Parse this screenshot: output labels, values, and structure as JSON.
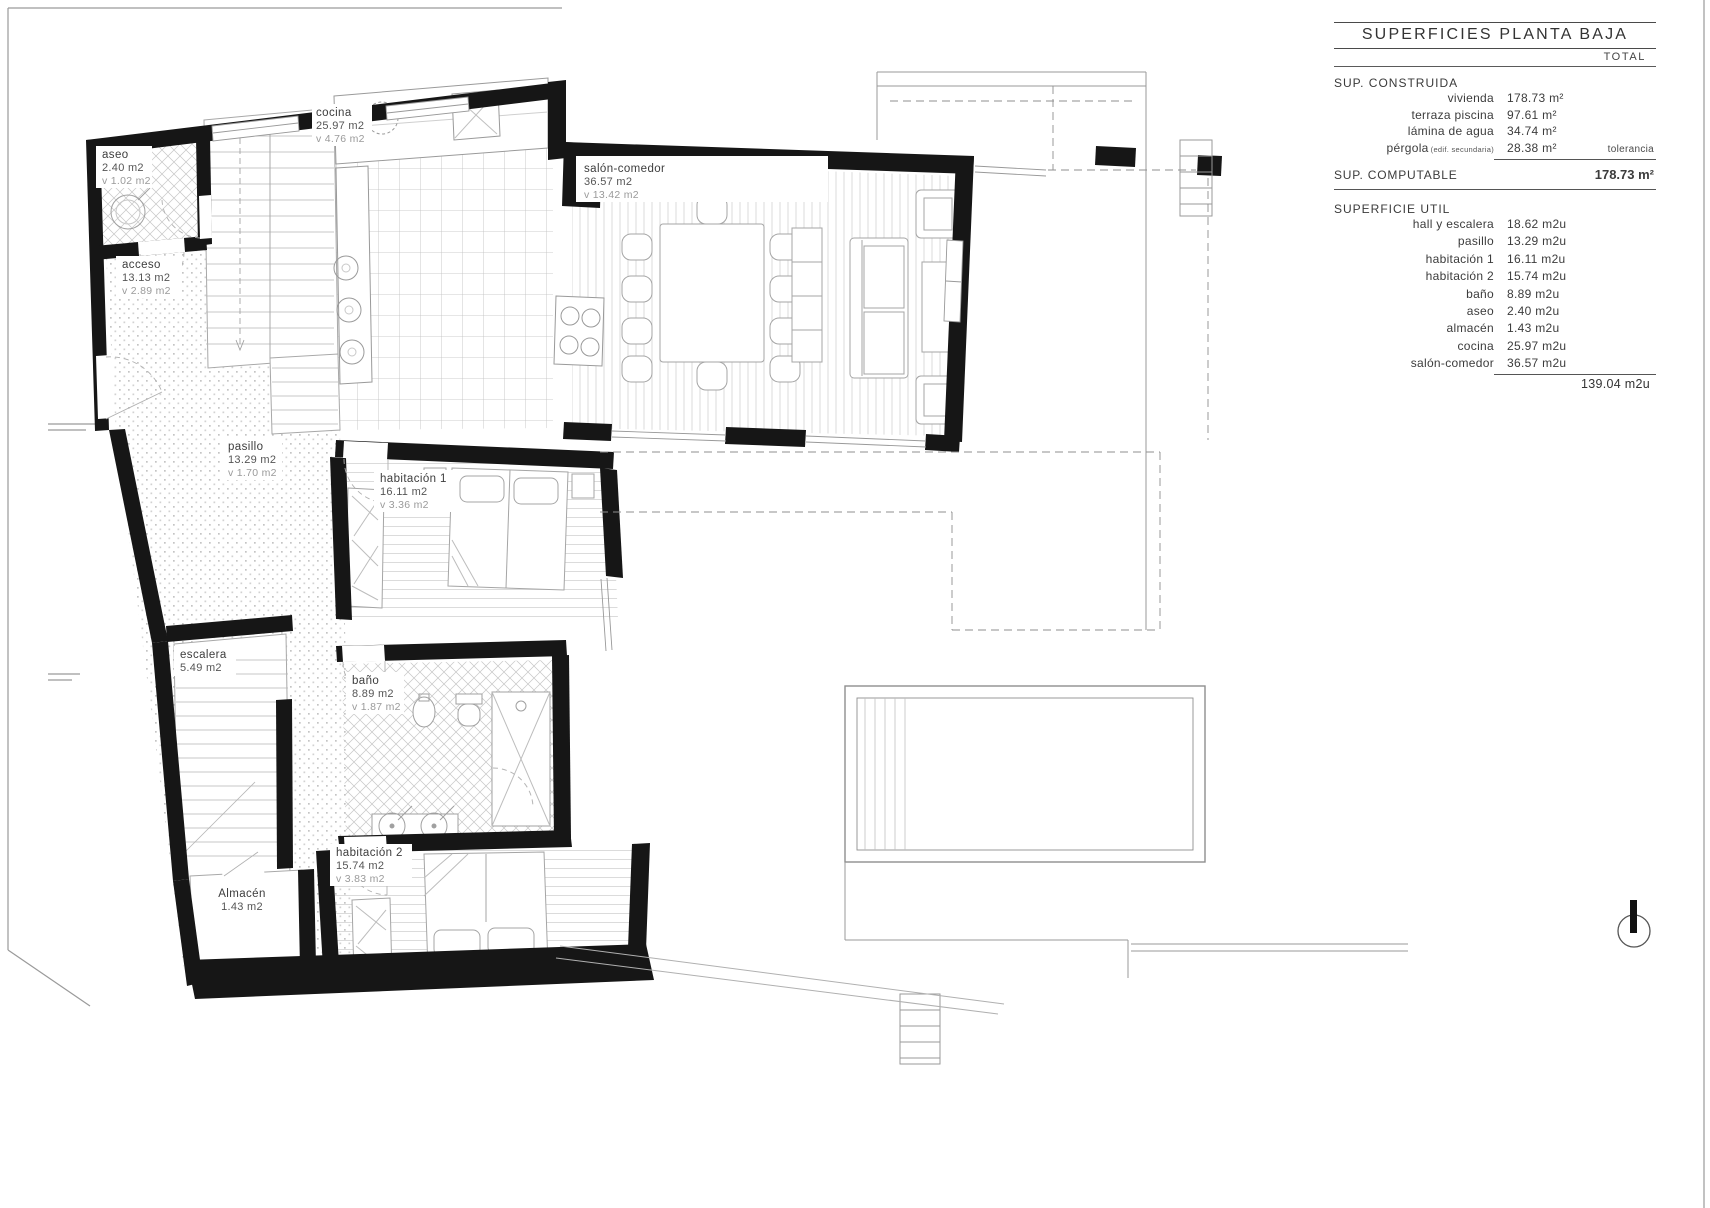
{
  "table": {
    "title": "SUPERFICIES PLANTA BAJA",
    "total_label": "TOTAL",
    "construida_label": "SUP. CONSTRUIDA",
    "construida_rows": [
      {
        "name": "vivienda",
        "value": "178.73 m²"
      },
      {
        "name": "terraza piscina",
        "value": "97.61 m²"
      },
      {
        "name": "lámina de agua",
        "value": "34.74 m²"
      },
      {
        "name": "pérgola",
        "note": "(edif. secundaria)",
        "value": "28.38 m²",
        "side_note": "tolerancia"
      }
    ],
    "computable_label": "SUP. COMPUTABLE",
    "computable_value": "178.73 m²",
    "util_label": "SUPERFICIE UTIL",
    "util_rows": [
      {
        "name": "hall y escalera",
        "value": "18.62 m2u"
      },
      {
        "name": "pasillo",
        "value": "13.29 m2u"
      },
      {
        "name": "habitación 1",
        "value": "16.11 m2u"
      },
      {
        "name": "habitación 2",
        "value": "15.74 m2u"
      },
      {
        "name": "baño",
        "value": "8.89 m2u"
      },
      {
        "name": "aseo",
        "value": "2.40 m2u"
      },
      {
        "name": "almacén",
        "value": "1.43 m2u"
      },
      {
        "name": "cocina",
        "value": "25.97 m2u"
      },
      {
        "name": "salón-comedor",
        "value": "36.57 m2u"
      }
    ],
    "util_total": "139.04 m2u"
  },
  "plan": {
    "rooms": [
      {
        "name": "aseo",
        "area": "2.40 m2",
        "vol": "v 1.02 m2"
      },
      {
        "name": "cocina",
        "area": "25.97 m2",
        "vol": "v 4.76 m2"
      },
      {
        "name": "salón-comedor",
        "area": "36.57 m2",
        "vol": "v 13.42 m2"
      },
      {
        "name": "acceso",
        "area": "13.13 m2",
        "vol": "v 2.89 m2"
      },
      {
        "name": "pasillo",
        "area": "13.29 m2",
        "vol": "v 1.70 m2"
      },
      {
        "name": "habitación 1",
        "area": "16.11 m2",
        "vol": "v 3.36 m2"
      },
      {
        "name": "escalera",
        "area": "5.49 m2"
      },
      {
        "name": "baño",
        "area": "8.89 m2",
        "vol": "v 1.87 m2"
      },
      {
        "name": "habitación 2",
        "area": "15.74 m2",
        "vol": "v 3.83 m2"
      },
      {
        "name": "Almacén",
        "area": "1.43 m2"
      }
    ]
  }
}
